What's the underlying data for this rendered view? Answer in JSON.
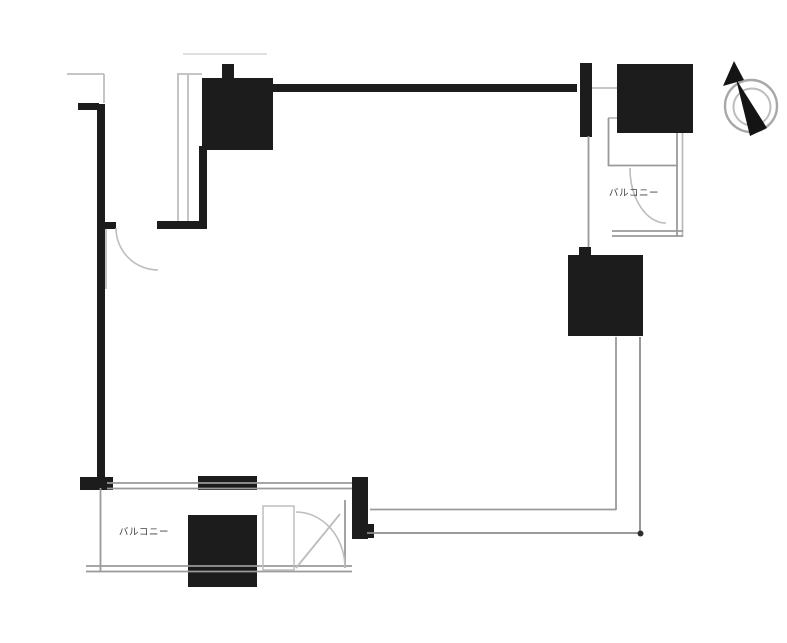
{
  "page": {
    "type": "floor-plan",
    "background": "#ffffff"
  },
  "labels": {
    "balcony_top_right": "バルコニー",
    "balcony_bottom_left": "バルコニー"
  },
  "colors": {
    "wall": "#1c1c1c",
    "outline_dark": "#8c8c8c",
    "outline": "#9a9a9a",
    "outline_light": "#bdbdbd",
    "outline_faint": "#dcdcdc",
    "label": "#3f3f3f",
    "compass_ring": "#a8a8a8"
  },
  "icons": {
    "compass": "north-arrow-icon"
  }
}
